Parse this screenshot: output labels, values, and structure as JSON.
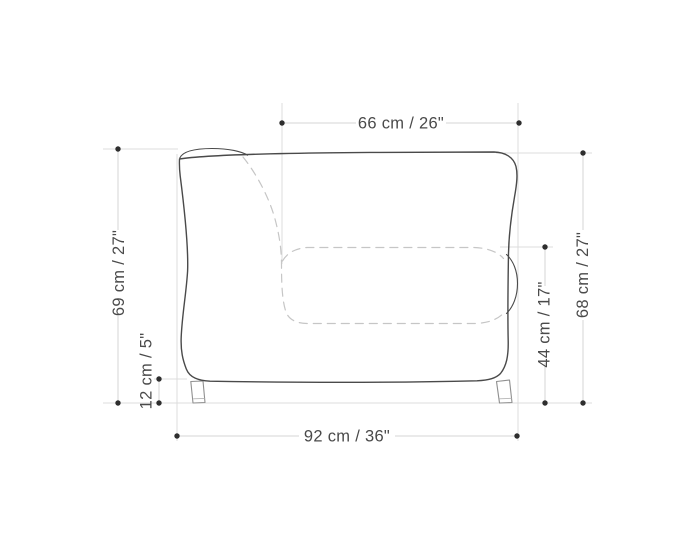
{
  "diagram": {
    "title": "Armchair side-view dimension drawing",
    "unit_format": "cm / inches",
    "background": "#ffffff",
    "colors": {
      "outline": "#4a4a4a",
      "hidden_dashed_lines": "#c6c6c6",
      "extension_lines": "#dcdcdc",
      "dimension_dots": "#2e2e2e",
      "legs": "#8f8f8f",
      "label_text": "#4a4a4a"
    },
    "labels": {
      "top": "66 cm / 26\"",
      "left_outer": "69 cm / 27\"",
      "left_inner": "12 cm / 5\"",
      "right_inner": "44 cm / 17\"",
      "right_outer": "68 cm / 27\"",
      "bottom": "92 cm / 36\""
    },
    "measurements": [
      {
        "position": "top",
        "label": "66 cm / 26\"",
        "cm": 66,
        "inches": 26,
        "orientation": "horizontal"
      },
      {
        "position": "left-outer",
        "label": "69 cm / 27\"",
        "cm": 69,
        "inches": 27,
        "orientation": "vertical"
      },
      {
        "position": "left-inner",
        "label": "12 cm / 5\"",
        "cm": 12,
        "inches": 5,
        "orientation": "vertical"
      },
      {
        "position": "right-inner",
        "label": "44 cm / 17\"",
        "cm": 44,
        "inches": 17,
        "orientation": "vertical"
      },
      {
        "position": "right-outer",
        "label": "68 cm / 27\"",
        "cm": 68,
        "inches": 27,
        "orientation": "vertical"
      },
      {
        "position": "bottom",
        "label": "92 cm / 36\"",
        "cm": 92,
        "inches": 36,
        "orientation": "horizontal"
      }
    ]
  }
}
